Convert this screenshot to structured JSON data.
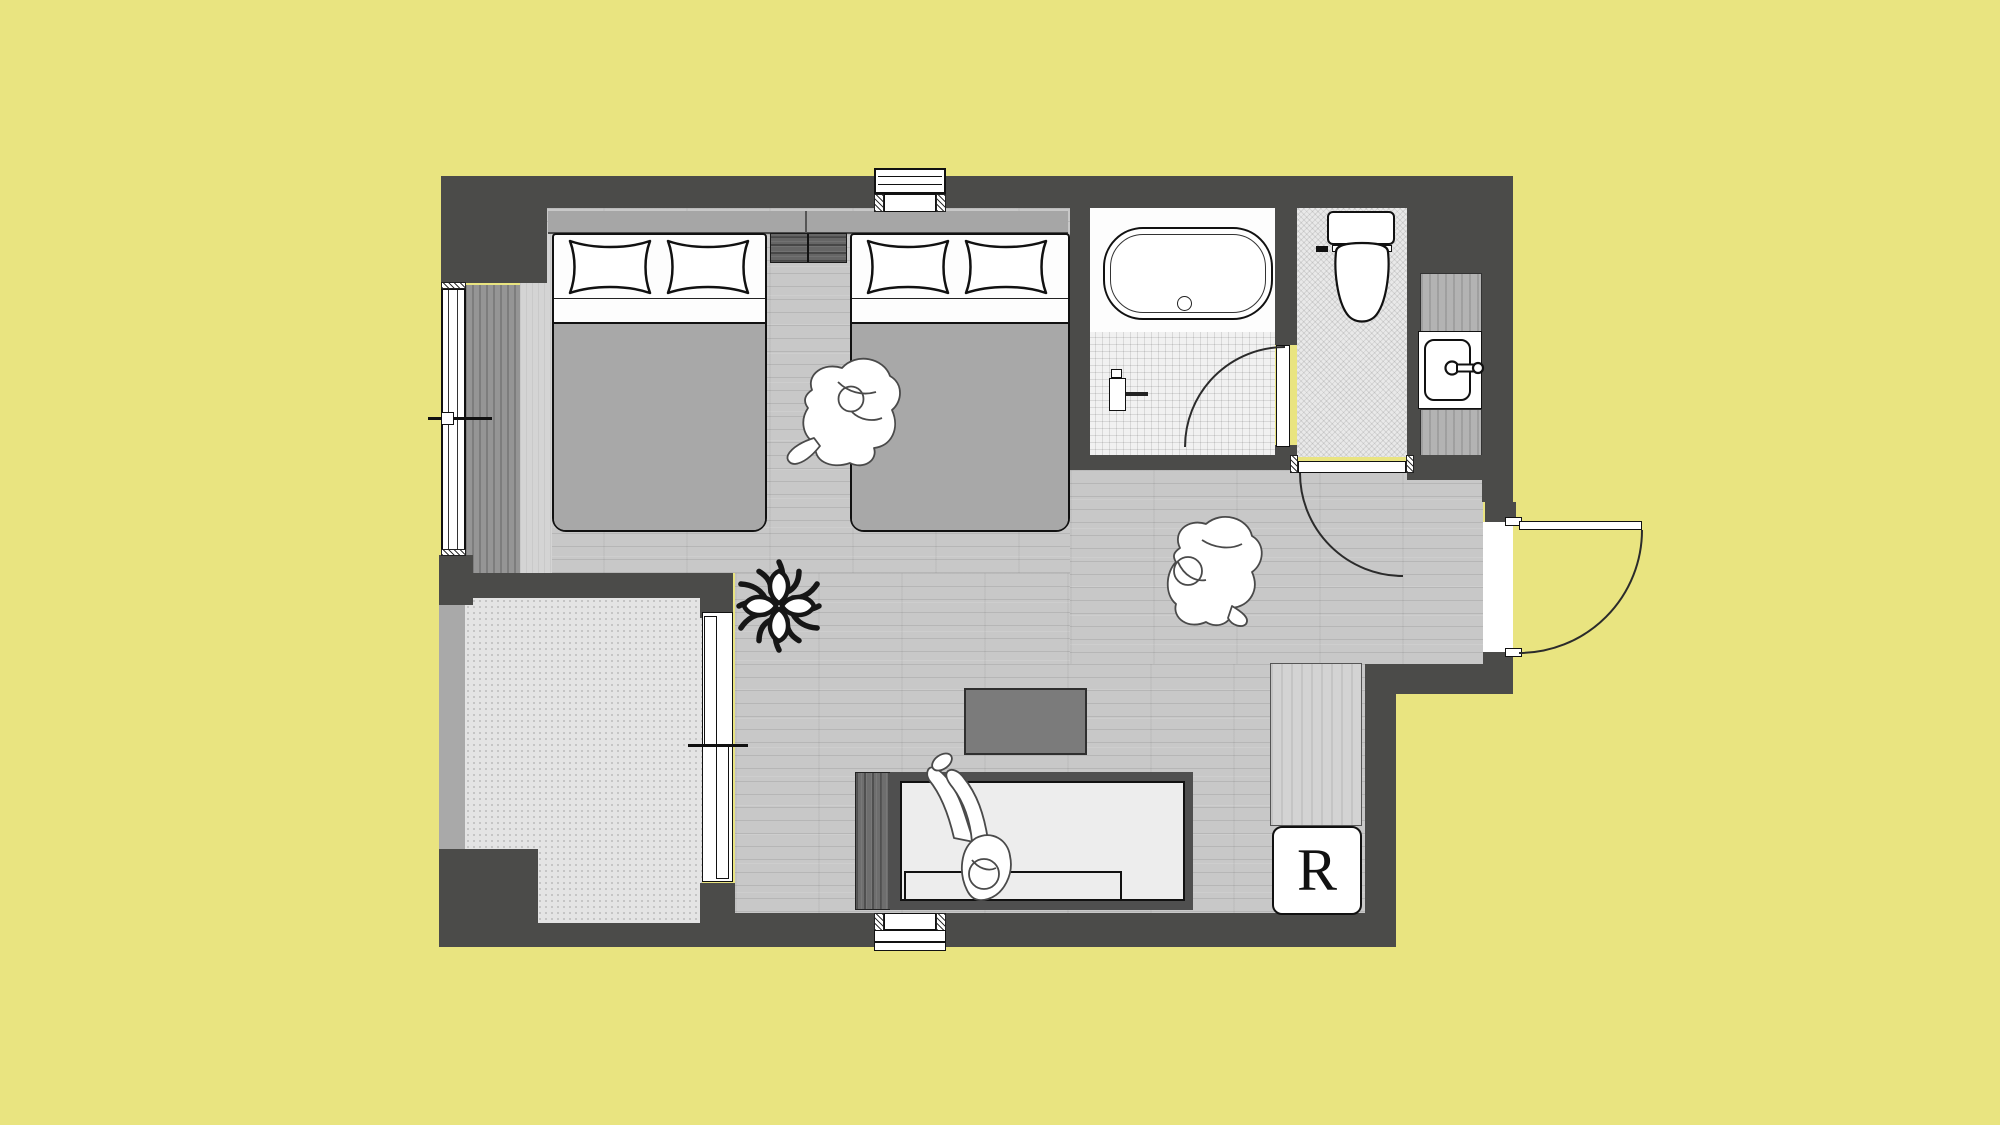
{
  "title": "Hotel twin room floor plan",
  "background_color": "#E9E480",
  "labels": {
    "refrigerator": "R"
  },
  "colors": {
    "wall": "#4B4B49",
    "floor_wood": "#C8C8C8",
    "balcony_floor": "#E4E4E4",
    "bathroom_tile": "#F1F1F1",
    "toilet_floor": "#E9E9E9",
    "headboard": "#A6A6A6",
    "bed_duvet": "#A8A8A8",
    "sofa_seat": "#EDEDED",
    "low_table": "#7B7B7B",
    "fixture_white": "#FFFFFF",
    "outline": "#111111"
  },
  "rooms": [
    {
      "name": "bedroom-living-area"
    },
    {
      "name": "bathroom-with-tub"
    },
    {
      "name": "toilet-room"
    },
    {
      "name": "washbasin-nook"
    },
    {
      "name": "entry"
    },
    {
      "name": "balcony"
    }
  ],
  "furniture_icons": [
    "twin-bed-left",
    "twin-bed-right",
    "pillow",
    "nightstand",
    "bathtub",
    "shower-mixer",
    "toilet",
    "washbasin",
    "faucet",
    "sofa",
    "low-table",
    "refrigerator",
    "closet-counter",
    "plant",
    "person-sitting-on-bed",
    "person-sitting-on-floor",
    "person-lying-on-sofa",
    "entry-door",
    "bathroom-door",
    "toilet-door",
    "balcony-sliding-door",
    "window",
    "wall-vent"
  ]
}
